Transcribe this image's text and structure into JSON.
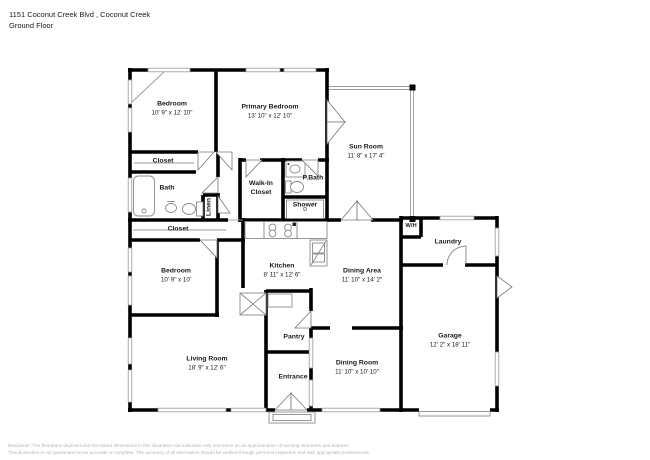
{
  "header": {
    "address": "1151 Coconut Creek Blvd , Coconut Creek",
    "floor": "Ground Floor"
  },
  "rooms": [
    {
      "id": "bedroom-1",
      "name": "Bedroom",
      "dims": "10' 9\" x 12' 10\""
    },
    {
      "id": "primary-bedroom",
      "name": "Primary Bedroom",
      "dims": "13' 10\" x 12' 10\""
    },
    {
      "id": "sun-room",
      "name": "Sun Room",
      "dims": "11' 8\" x 17' 4\""
    },
    {
      "id": "closet-top",
      "name": "Closet",
      "dims": ""
    },
    {
      "id": "bath",
      "name": "Bath",
      "dims": ""
    },
    {
      "id": "linen",
      "name": "Linen",
      "dims": ""
    },
    {
      "id": "walk-in-closet",
      "name": "Walk-In Closet",
      "dims": ""
    },
    {
      "id": "p-bath",
      "name": "P.Bath",
      "dims": ""
    },
    {
      "id": "shower",
      "name": "Shower",
      "dims": ""
    },
    {
      "id": "closet-mid",
      "name": "Closet",
      "dims": ""
    },
    {
      "id": "bedroom-2",
      "name": "Bedroom",
      "dims": "10' 9\" x 10'"
    },
    {
      "id": "kitchen",
      "name": "Kitchen",
      "dims": "8' 11\" x 12' 6\""
    },
    {
      "id": "dining-area",
      "name": "Dining Area",
      "dims": "11' 10\" x 14' 2\""
    },
    {
      "id": "water-heater",
      "name": "W/H",
      "dims": ""
    },
    {
      "id": "laundry",
      "name": "Laundry",
      "dims": ""
    },
    {
      "id": "garage",
      "name": "Garage",
      "dims": "12' 2\" x 18' 11\""
    },
    {
      "id": "living-room",
      "name": "Living Room",
      "dims": "18' 9\" x 12' 6\""
    },
    {
      "id": "pantry",
      "name": "Pantry",
      "dims": ""
    },
    {
      "id": "entrance",
      "name": "Entrance",
      "dims": ""
    },
    {
      "id": "dining-room",
      "name": "Dining Room",
      "dims": "11' 10\" x 10' 10\""
    }
  ],
  "fixtures": [
    "bathtub",
    "pedestal-sink",
    "toilet",
    "vanity-sink",
    "shower",
    "stove",
    "kitchen-sink",
    "closet-rod",
    "shelves",
    "porch-step",
    "garage-door"
  ],
  "disclaimer": {
    "line1": "Disclaimer: The floorplans depicted and the stated dimensions in this illustration are indicative only and serve as an approximation of existing structures and features.",
    "line2": "This illustration is not guaranteed to be accurate or complete. The accuracy of all information should be verified through personal inspection and with appropriate professionals."
  },
  "colors": {
    "wall": "#000000",
    "window": "#9a9a9a",
    "fixture": "#8a8a8a",
    "label": "#1a1a1a",
    "disclaimer": "#b5b5b5"
  }
}
